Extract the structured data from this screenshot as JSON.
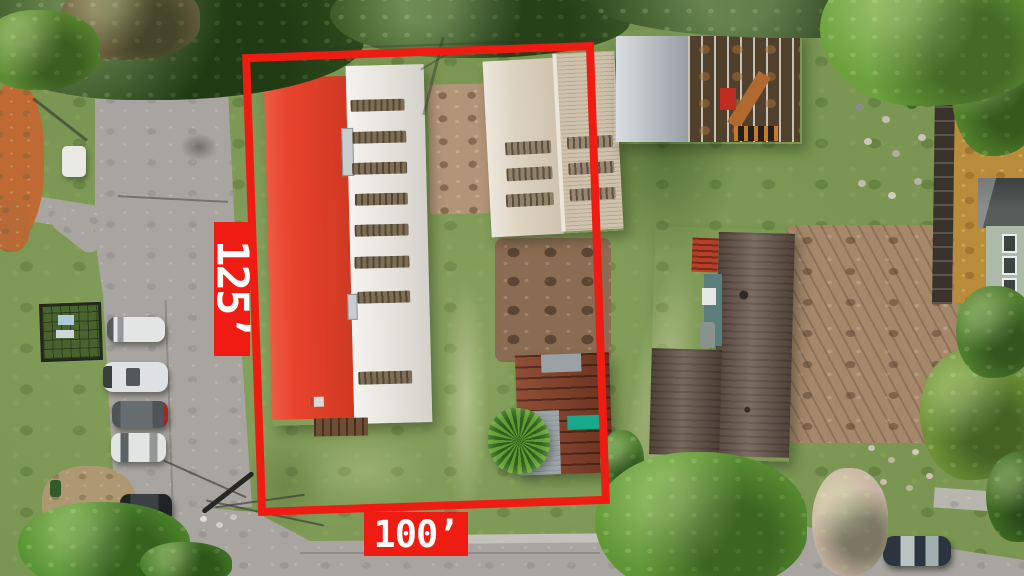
{
  "annotations": {
    "side_label": "125’",
    "front_label": "100’"
  },
  "colors": {
    "annotation_red": "#ee1c12",
    "label_text": "#ffffff",
    "red_roof": "#e8432c",
    "white_roof": "#ebe8e2",
    "beige_roof_left": "#ddd3c1",
    "beige_roof_right": "#cfc3ad",
    "rust_roof": "#81402a",
    "shingle_roof": "#6d5c50",
    "grass": "#7a9652",
    "pavement": "#a8a5a0"
  }
}
